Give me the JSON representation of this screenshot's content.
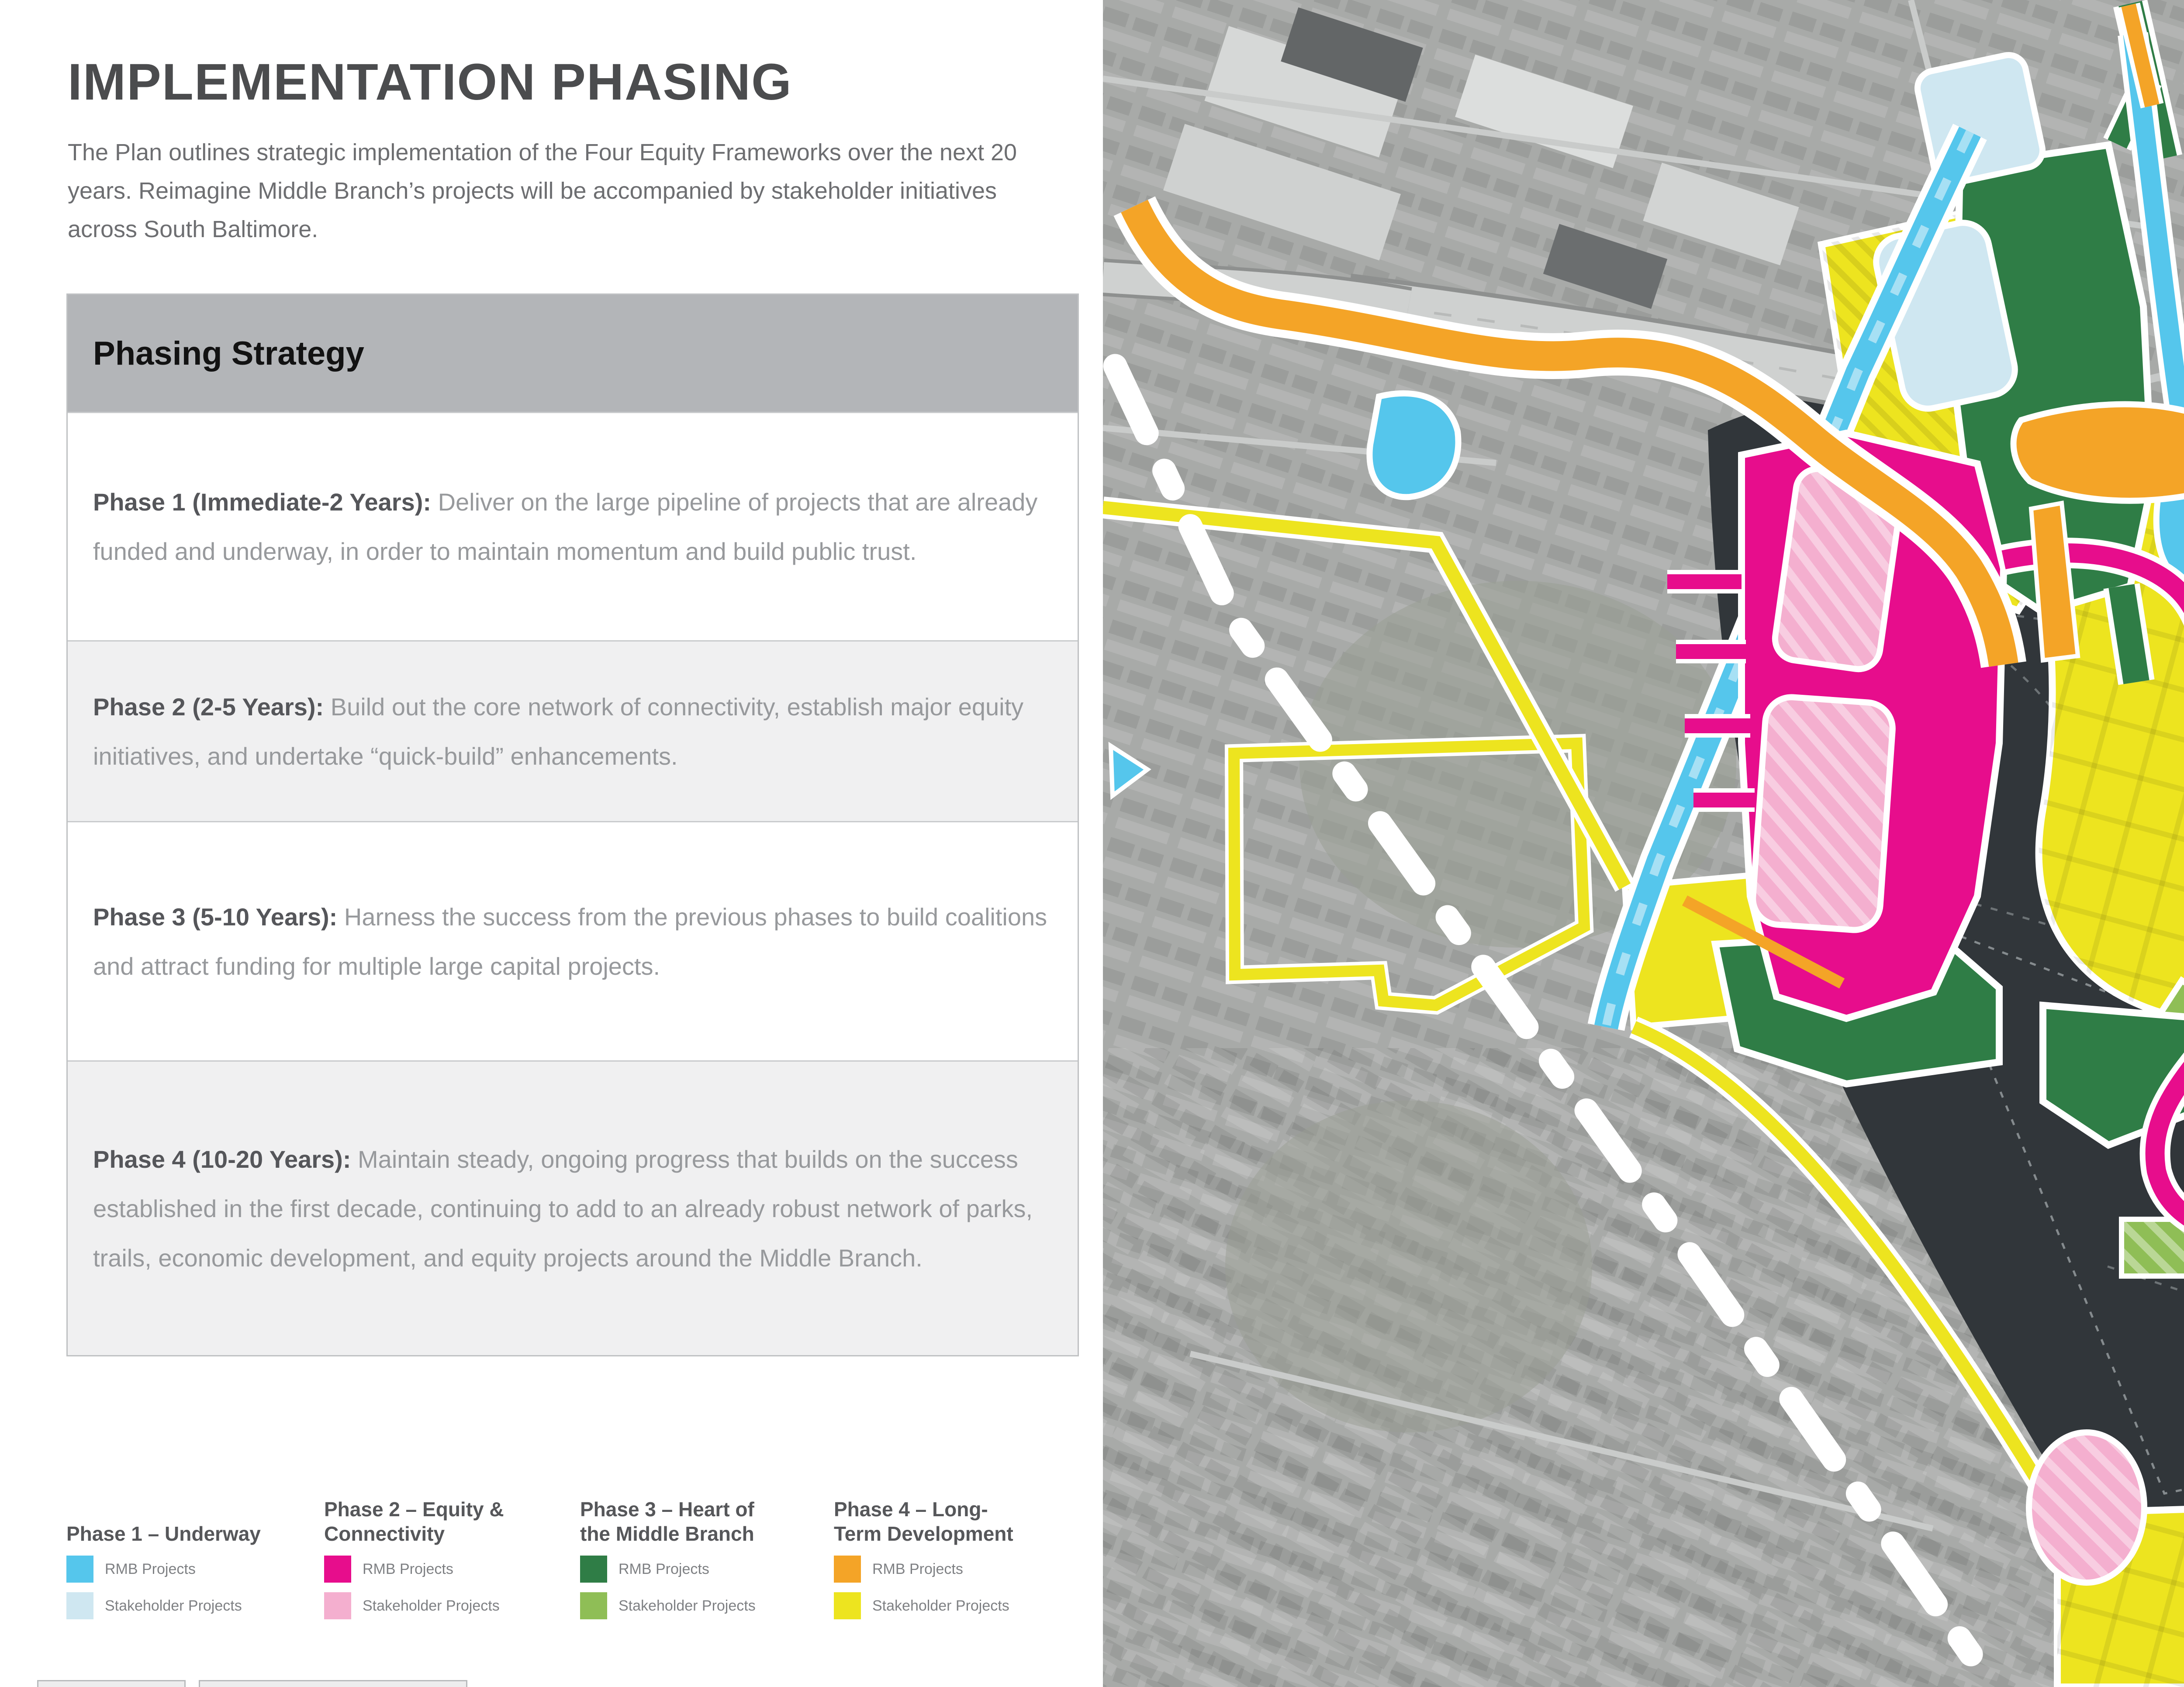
{
  "page": {
    "title": "IMPLEMENTATION PHASING",
    "intro": "The Plan outlines strategic implementation of the Four Equity Frameworks over the next 20 years. Reimagine Middle Branch’s projects will be accompanied by stakeholder initiatives across South Baltimore."
  },
  "phasing": {
    "header": "Phasing Strategy",
    "rows": [
      {
        "lead": "Phase 1 (Immediate-2 Years):",
        "body": "Deliver on the large pipeline of projects that are already funded and underway, in order to maintain momentum and build public trust."
      },
      {
        "lead": "Phase 2 (2-5 Years):",
        "body": "Build out the core network of connectivity, establish major equity initiatives, and undertake “quick-build” enhancements."
      },
      {
        "lead": "Phase 3 (5-10 Years):",
        "body": "Harness the success from the previous phases to build coalitions and attract funding for multiple large capital projects."
      },
      {
        "lead": "Phase 4 (10-20 Years):",
        "body": "Maintain steady, ongoing progress that builds on the success established in the first decade, continuing to add to an already robust network of parks, trails, economic development, and equity projects around the Middle Branch."
      }
    ]
  },
  "legend": {
    "columns": [
      {
        "title": "Phase 1 – Underway",
        "rmb_label": "RMB Projects",
        "stakeholder_label": "Stakeholder Projects",
        "rmb_color": "#55C6EC",
        "stakeholder_color": "#CFE7F1"
      },
      {
        "title": "Phase 2 – Equity & Connectivity",
        "rmb_label": "RMB Projects",
        "stakeholder_label": "Stakeholder Projects",
        "rmb_color": "#E70D8C",
        "stakeholder_color": "#F4AFCF"
      },
      {
        "title": "Phase 3 – Heart of the Middle Branch",
        "rmb_label": "RMB Projects",
        "stakeholder_label": "Stakeholder Projects",
        "rmb_color": "#2F7D46",
        "stakeholder_color": "#8FBE56"
      },
      {
        "title": "Phase 4 – Long-Term Development",
        "rmb_label": "RMB Projects",
        "stakeholder_label": "Stakeholder Projects",
        "rmb_color": "#F4A427",
        "stakeholder_color": "#EDE41F"
      }
    ]
  },
  "map": {
    "colors": {
      "water": "#31363A",
      "land": "#A8AAA8",
      "boundary": "#FFFFFF",
      "p1r": "#55C6EC",
      "p1s": "#CFE7F1",
      "p2r": "#E70D8C",
      "p2s": "#F4AFCF",
      "p3r": "#2F7D46",
      "p3s": "#8FBE56",
      "p4r": "#F4A427",
      "p4s": "#EDE41F"
    }
  }
}
